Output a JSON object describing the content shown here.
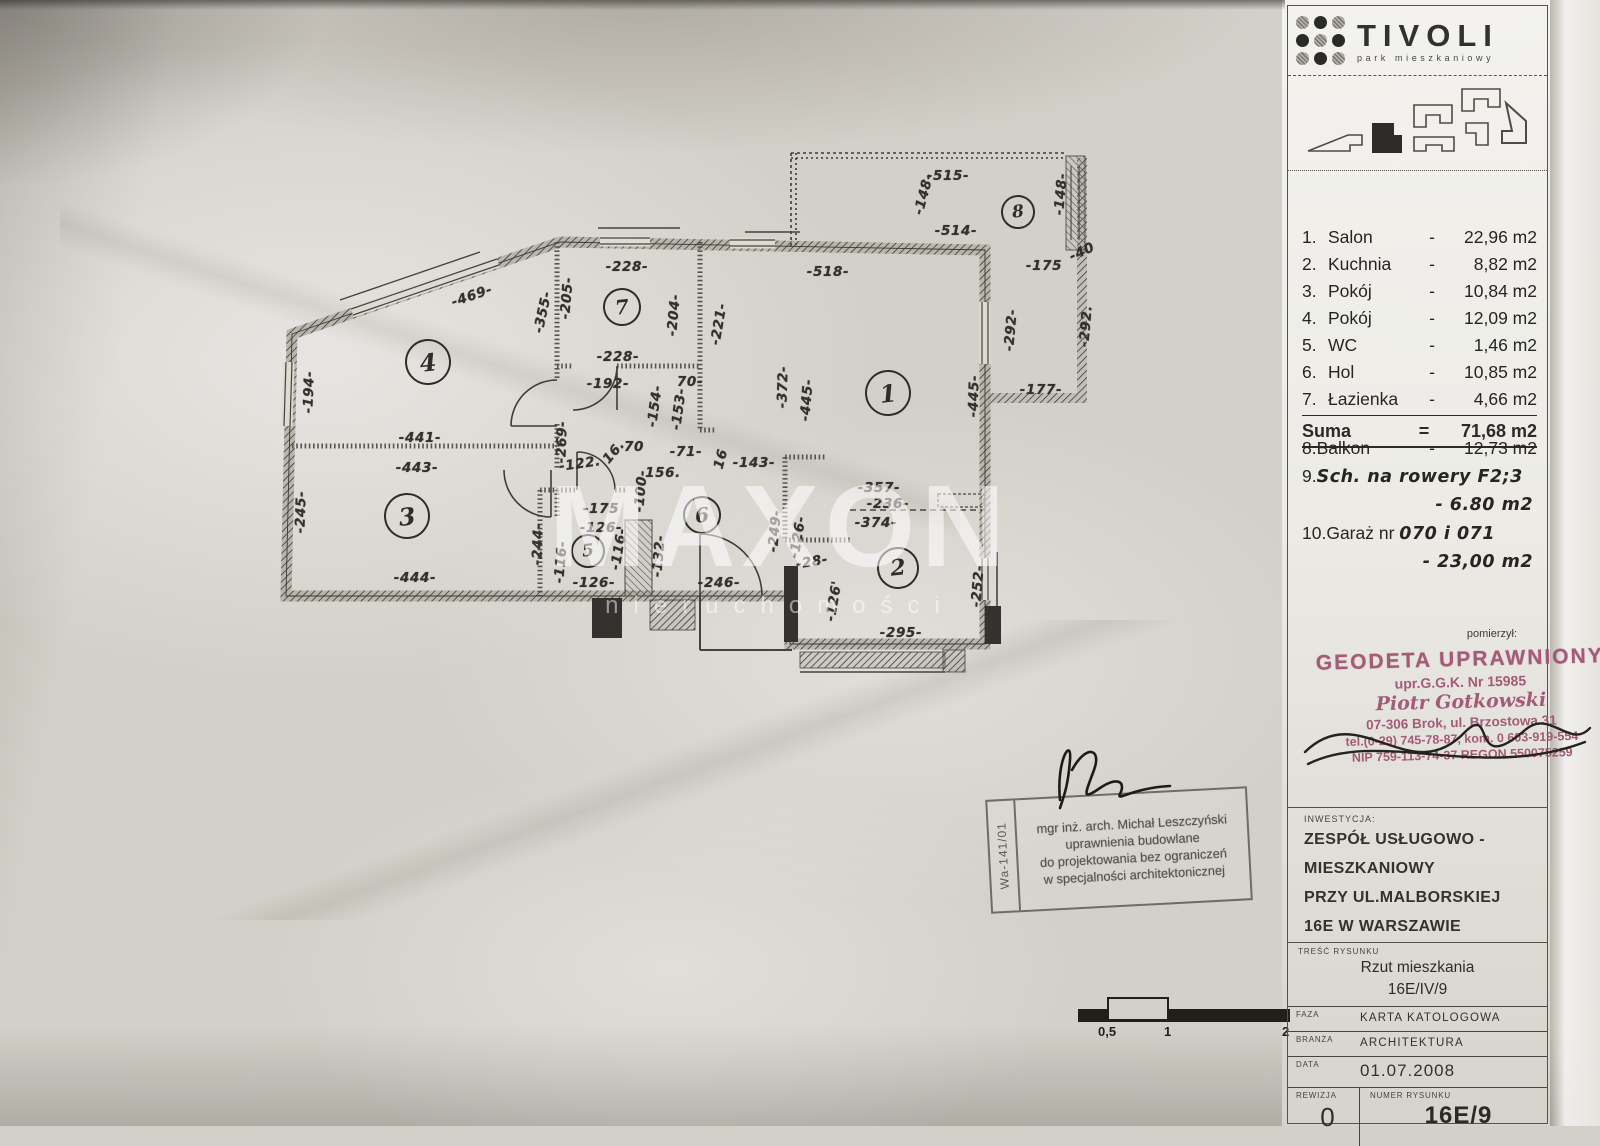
{
  "logo": {
    "brand": "TIVOLI",
    "subtitle": "park mieszkaniowy"
  },
  "room_list": {
    "rows": [
      {
        "no": "1.",
        "name": "Salon",
        "dash": "-",
        "value": "22,96 m2"
      },
      {
        "no": "2.",
        "name": "Kuchnia",
        "dash": "-",
        "value": "8,82 m2"
      },
      {
        "no": "3.",
        "name": "Pokój",
        "dash": "-",
        "value": "10,84 m2"
      },
      {
        "no": "4.",
        "name": "Pokój",
        "dash": "-",
        "value": "12,09 m2"
      },
      {
        "no": "5.",
        "name": "WC",
        "dash": "-",
        "value": "1,46 m2"
      },
      {
        "no": "6.",
        "name": "Hol",
        "dash": "-",
        "value": "10,85 m2"
      },
      {
        "no": "7.",
        "name": "Łazienka",
        "dash": "-",
        "value": "4,66 m2"
      }
    ],
    "suma": {
      "label": "Suma",
      "eq": "=",
      "value": "71,68 m2"
    }
  },
  "extras": {
    "balkon_no": "8.",
    "balkon_name": "Balkon",
    "balkon_dash": "-",
    "balkon_value": "12,73 m2",
    "sch_no": "9.",
    "sch_text": "Sch. na rowery F2;3",
    "sch_value": "-  6.80  m2",
    "garaz_printed": "10.Garaż nr",
    "garaz_number": "070 i 071",
    "garaz_value": "-  23,00  m2"
  },
  "pomierzyl": "pomierzył:",
  "geodeta_stamp": {
    "line1": "GEODETA UPRAWNIONY",
    "line2": "upr.G.G.K. Nr 15985",
    "line3": "Piotr Gotkowski",
    "line4": "07-306 Brok, ul. Brzostowa 31",
    "line5": "tel.(0-29) 745-78-87, kom. 0 603-919-554",
    "line6": "NIP 759-113-74-37 REGON 550075259",
    "color": "#a05472"
  },
  "inwestycja": {
    "label": "INWESTYCJA:",
    "lines": [
      "ZESPÓŁ USŁUGOWO -",
      "MIESZKANIOWY",
      "PRZY UL.MALBORSKIEJ",
      "16E W WARSZAWIE"
    ]
  },
  "tresc": {
    "label": "TREŚĆ RYSUNKU",
    "line1": "Rzut mieszkania",
    "line2": "16E/IV/9"
  },
  "meta": {
    "faza_label": "FAZA",
    "faza": "KARTA KATOLOGOWA",
    "branza_label": "BRANŻA",
    "branza": "ARCHITEKTURA",
    "data_label": "DATA",
    "data": "01.07.2008",
    "rewizja_label": "REWIZJA",
    "rewizja": "0",
    "numer_label": "NUMER RYSUNKU",
    "numer": "16E/9"
  },
  "architect_stamp": {
    "side": "Wa-141/01",
    "lines": [
      "mgr inż. arch. Michał Leszczyński",
      "uprawnienia budowlane",
      "do projektowania bez ograniczeń",
      "w specjalności architektonicznej"
    ]
  },
  "scale_bar": {
    "label_05": "0,5",
    "label_1": "1",
    "label_2": "2"
  },
  "watermark": {
    "line1": "MAXON",
    "line2": "nieruchomości"
  },
  "plan": {
    "rooms": [
      {
        "n": "1",
        "x": 888,
        "y": 393,
        "d": 42
      },
      {
        "n": "2",
        "x": 898,
        "y": 568,
        "d": 38
      },
      {
        "n": "3",
        "x": 407,
        "y": 516,
        "d": 42
      },
      {
        "n": "4",
        "x": 428,
        "y": 362,
        "d": 42
      },
      {
        "n": "5",
        "x": 588,
        "y": 551,
        "d": 30
      },
      {
        "n": "6",
        "x": 702,
        "y": 515,
        "d": 34
      },
      {
        "n": "7",
        "x": 622,
        "y": 307,
        "d": 34
      },
      {
        "n": "8",
        "x": 1018,
        "y": 212,
        "d": 30
      }
    ],
    "dims": [
      {
        "t": "-469-",
        "x": 472,
        "y": 296,
        "r": -19
      },
      {
        "t": "-194-",
        "x": 309,
        "y": 392,
        "r": -88
      },
      {
        "t": "-441-",
        "x": 420,
        "y": 438,
        "r": 0
      },
      {
        "t": "-443-",
        "x": 417,
        "y": 468,
        "r": 0
      },
      {
        "t": "-245-",
        "x": 301,
        "y": 512,
        "r": -88
      },
      {
        "t": "-444-",
        "x": 415,
        "y": 578,
        "r": 0
      },
      {
        "t": "-355-",
        "x": 543,
        "y": 312,
        "r": -78
      },
      {
        "t": "-205-",
        "x": 567,
        "y": 298,
        "r": -85
      },
      {
        "t": "-228-",
        "x": 627,
        "y": 267,
        "r": 0
      },
      {
        "t": "-204-",
        "x": 674,
        "y": 315,
        "r": -85
      },
      {
        "t": "-221-",
        "x": 719,
        "y": 324,
        "r": -80
      },
      {
        "t": "-228-",
        "x": 618,
        "y": 357,
        "r": 0
      },
      {
        "t": "-192-",
        "x": 608,
        "y": 384,
        "r": 0
      },
      {
        "t": "70-",
        "x": 690,
        "y": 382,
        "r": 0
      },
      {
        "t": "-154-",
        "x": 655,
        "y": 406,
        "r": -82
      },
      {
        "t": "-153-",
        "x": 679,
        "y": 409,
        "r": -82
      },
      {
        "t": "-269-",
        "x": 562,
        "y": 442,
        "r": -88
      },
      {
        "t": "-372-",
        "x": 783,
        "y": 387,
        "r": -88
      },
      {
        "t": "-445-",
        "x": 807,
        "y": 400,
        "r": -85
      },
      {
        "t": "-445-",
        "x": 974,
        "y": 396,
        "r": -88
      },
      {
        "t": "-518-",
        "x": 828,
        "y": 272,
        "r": 0
      },
      {
        "t": "-515-",
        "x": 948,
        "y": 176,
        "r": 0
      },
      {
        "t": "-148-",
        "x": 924,
        "y": 194,
        "r": -75
      },
      {
        "t": "-514-",
        "x": 956,
        "y": 231,
        "r": 0
      },
      {
        "t": "-148-",
        "x": 1061,
        "y": 194,
        "r": -85
      },
      {
        "t": "-175",
        "x": 1044,
        "y": 266,
        "r": 0
      },
      {
        "t": "-40",
        "x": 1082,
        "y": 252,
        "r": -25
      },
      {
        "t": "-292-",
        "x": 1011,
        "y": 330,
        "r": -85
      },
      {
        "t": "-292.",
        "x": 1086,
        "y": 326,
        "r": -85
      },
      {
        "t": "-177-",
        "x": 1041,
        "y": 390,
        "r": 0
      },
      {
        "t": "-122.",
        "x": 580,
        "y": 464,
        "r": -8
      },
      {
        "t": "16.",
        "x": 614,
        "y": 452,
        "r": -50
      },
      {
        "t": "70",
        "x": 634,
        "y": 447,
        "r": 0
      },
      {
        "t": "-71-",
        "x": 686,
        "y": 452,
        "r": 0
      },
      {
        "t": "156.",
        "x": 663,
        "y": 473,
        "r": 0
      },
      {
        "t": "-100-",
        "x": 641,
        "y": 491,
        "r": -85
      },
      {
        "t": "16",
        "x": 721,
        "y": 459,
        "r": -75
      },
      {
        "t": "-143-",
        "x": 754,
        "y": 463,
        "r": 0
      },
      {
        "t": "-175",
        "x": 601,
        "y": 509,
        "r": 0
      },
      {
        "t": "-126-",
        "x": 601,
        "y": 528,
        "r": 0
      },
      {
        "t": "-116-",
        "x": 561,
        "y": 562,
        "r": -85
      },
      {
        "t": "-126-",
        "x": 594,
        "y": 583,
        "r": 0
      },
      {
        "t": "-244-",
        "x": 538,
        "y": 544,
        "r": -88
      },
      {
        "t": "-116-",
        "x": 619,
        "y": 549,
        "r": -80
      },
      {
        "t": "-132-",
        "x": 659,
        "y": 556,
        "r": -85
      },
      {
        "t": "-246-",
        "x": 719,
        "y": 583,
        "r": 0
      },
      {
        "t": "-249-",
        "x": 775,
        "y": 531,
        "r": -85
      },
      {
        "t": "-126-",
        "x": 798,
        "y": 537,
        "r": -80
      },
      {
        "t": "-28-",
        "x": 812,
        "y": 562,
        "r": -10
      },
      {
        "t": "-357-",
        "x": 879,
        "y": 488,
        "r": 0
      },
      {
        "t": "-236-",
        "x": 888,
        "y": 504,
        "r": 0
      },
      {
        "t": "-374-",
        "x": 876,
        "y": 523,
        "r": 0
      },
      {
        "t": "-295-",
        "x": 901,
        "y": 633,
        "r": 0
      },
      {
        "t": "-126'",
        "x": 834,
        "y": 601,
        "r": -80
      },
      {
        "t": "-252-",
        "x": 978,
        "y": 586,
        "r": -85
      }
    ]
  }
}
